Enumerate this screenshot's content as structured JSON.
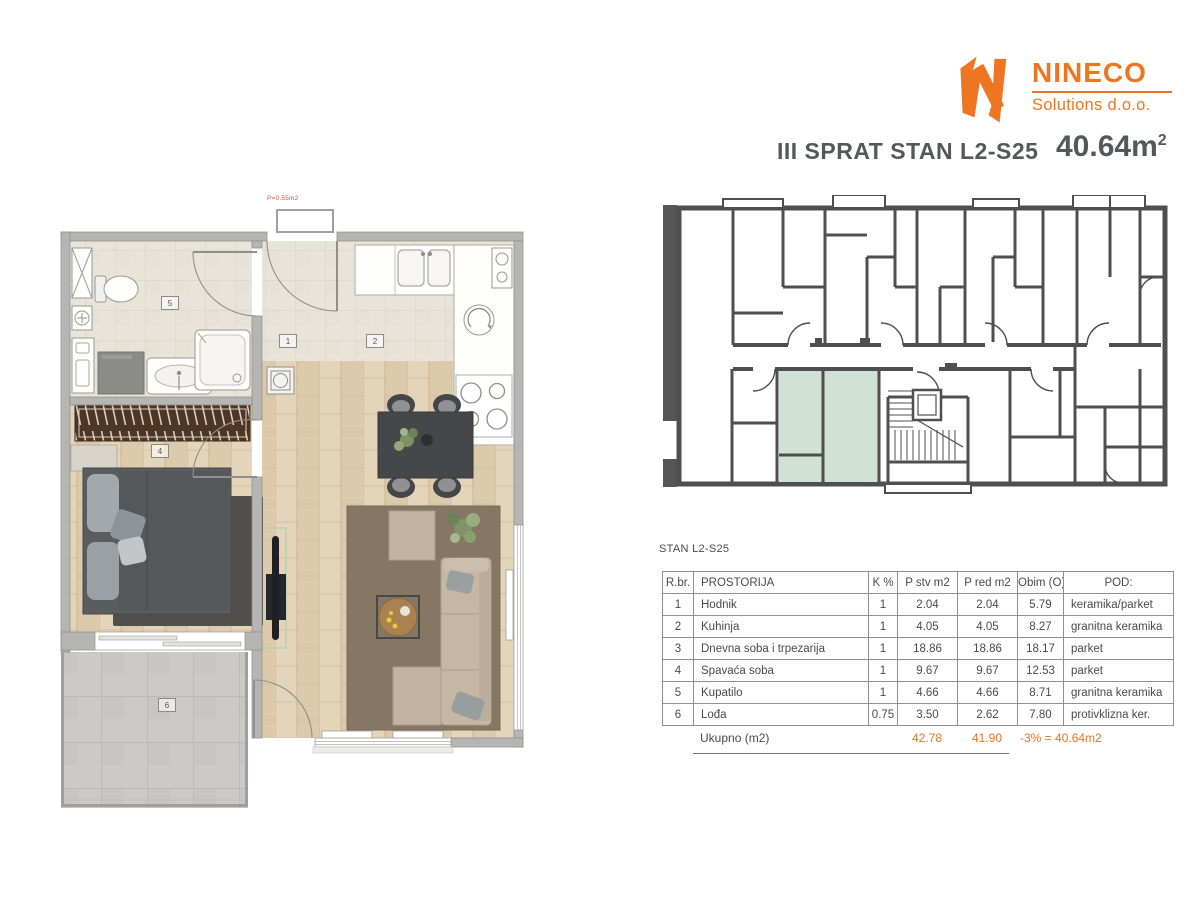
{
  "colors": {
    "accent": "#ee7623",
    "totals": "#e87425",
    "highlight": "#cfe2d3",
    "ink": "#4a4a4c"
  },
  "logo": {
    "brand": "NINECO",
    "subtitle": "Solutions d.o.o."
  },
  "header": {
    "title": "III SPRAT STAN L2-S25",
    "area_value": "40.64m",
    "area_sup": "2"
  },
  "apartment": {
    "shaft_label": "P=0.55m2",
    "labels": {
      "hodnik": "1",
      "kuhinja": "2",
      "spavaca_soba": "4",
      "kupatilo": "5",
      "lodja": "6"
    }
  },
  "table": {
    "caption": "STAN L2-S25",
    "headers": [
      "R.br.",
      "PROSTORIJA",
      "K %",
      "P stv m2",
      "P red m2",
      "Obim (O)",
      "POD:"
    ],
    "rows": [
      {
        "num": "1",
        "name": "Hodnik",
        "k": "1",
        "p_stv": "2.04",
        "p_red": "2.04",
        "obim": "5.79",
        "pod": "keramika/parket"
      },
      {
        "num": "2",
        "name": "Kuhinja",
        "k": "1",
        "p_stv": "4.05",
        "p_red": "4.05",
        "obim": "8.27",
        "pod": "granitna keramika"
      },
      {
        "num": "3",
        "name": "Dnevna soba i trpezarija",
        "k": "1",
        "p_stv": "18.86",
        "p_red": "18.86",
        "obim": "18.17",
        "pod": "parket"
      },
      {
        "num": "4",
        "name": "Spavaća soba",
        "k": "1",
        "p_stv": "9.67",
        "p_red": "9.67",
        "obim": "12.53",
        "pod": "parket"
      },
      {
        "num": "5",
        "name": "Kupatilo",
        "k": "1",
        "p_stv": "4.66",
        "p_red": "4.66",
        "obim": "8.71",
        "pod": "granitna keramika"
      },
      {
        "num": "6",
        "name": "Lođa",
        "k": "0.75",
        "p_stv": "3.50",
        "p_red": "2.62",
        "obim": "7.80",
        "pod": "protivklizna ker."
      }
    ],
    "totals": {
      "label": "Ukupno (m2)",
      "p_stv": "42.78",
      "p_red": "41.90",
      "note": "-3% = 40.64m2"
    }
  }
}
